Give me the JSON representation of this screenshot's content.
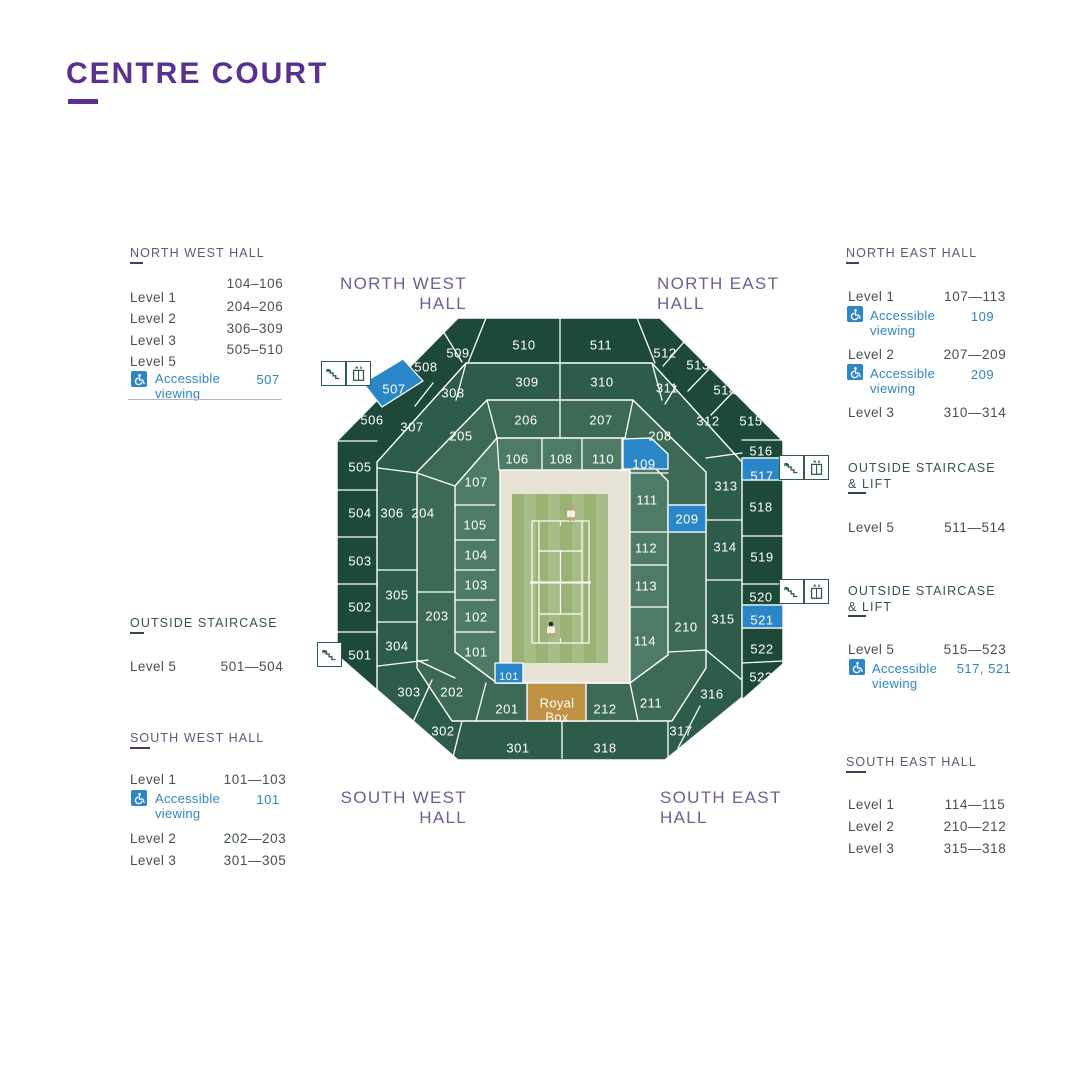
{
  "page": {
    "title": "CENTRE COURT"
  },
  "colors": {
    "accent_purple": "#5a3090",
    "hall_label_purple": "#6a5f96",
    "panel_heading_purple": "#5e5878",
    "staircase_heading_green": "#35544a",
    "body_text": "#44524d",
    "accessible_blue": "#2e86c3",
    "section_blue": "#2a86c7",
    "level5_green": "#1d4939",
    "level3_green": "#2e5c4a",
    "level2_green": "#3c6a56",
    "level1_green": "#4d7b65",
    "royal_box_gold": "#c09243",
    "surround_beige": "#e7e3d5",
    "grass_light": "#a7bd87",
    "grass_dark": "#9ab274",
    "icon_teal": "#2e5c4b"
  },
  "panels": {
    "nw": {
      "heading": "NORTH WEST HALL",
      "rows": [
        {
          "label": "Level 1",
          "value": "104–106"
        },
        {
          "label": "Level 2",
          "value": "204–206"
        },
        {
          "label": "Level 3",
          "value": "306–309"
        },
        {
          "label": "Level 5",
          "value": "505–510"
        }
      ],
      "acc": {
        "label": "Accessible viewing",
        "value": "507"
      }
    },
    "os_w": {
      "heading": "OUTSIDE STAIRCASE",
      "rows": [
        {
          "label": "Level 5",
          "value": "501—504"
        }
      ]
    },
    "sw": {
      "heading": "SOUTH WEST HALL",
      "rows": [
        {
          "label": "Level 1",
          "value": "101—103"
        },
        {
          "label": "Level 2",
          "value": "202—203"
        },
        {
          "label": "Level 3",
          "value": "301—305"
        }
      ],
      "acc": {
        "label": "Accessible viewing",
        "value": "101"
      }
    },
    "ne": {
      "heading": "NORTH EAST HALL",
      "rows": [
        {
          "label": "Level 1",
          "value": "107—113"
        },
        {
          "label": "Level 2",
          "value": "207—209"
        },
        {
          "label": "Level 3",
          "value": "310—314"
        }
      ],
      "acc1": {
        "label": "Accessible viewing",
        "value": "109"
      },
      "acc2": {
        "label": "Accessible viewing",
        "value": "209"
      }
    },
    "os_e1": {
      "heading": "OUTSIDE STAIRCASE & LIFT",
      "rows": [
        {
          "label": "Level 5",
          "value": "511—514"
        }
      ]
    },
    "os_e2": {
      "heading": "OUTSIDE STAIRCASE & LIFT",
      "rows": [
        {
          "label": "Level 5",
          "value": "515—523"
        }
      ],
      "acc": {
        "label": "Accessible viewing",
        "value": "517, 521"
      }
    },
    "se": {
      "heading": "SOUTH EAST HALL",
      "rows": [
        {
          "label": "Level 1",
          "value": "114—115"
        },
        {
          "label": "Level 2",
          "value": "210—212"
        },
        {
          "label": "Level 3",
          "value": "315—318"
        }
      ]
    }
  },
  "map": {
    "hall_labels": {
      "nw": {
        "line1": "NORTH WEST",
        "line2": "HALL"
      },
      "ne": {
        "line1": "NORTH EAST",
        "line2": "HALL"
      },
      "sw": {
        "line1": "SOUTH WEST",
        "line2": "HALL"
      },
      "se": {
        "line1": "SOUTH EAST",
        "line2": "HALL"
      }
    },
    "royal_box": {
      "line1": "Royal",
      "line2": "Box"
    },
    "icon_groups": [
      {
        "id": "nw-corner",
        "icons": [
          "stairs",
          "lift"
        ]
      },
      {
        "id": "west",
        "icons": [
          "stairs"
        ]
      },
      {
        "id": "east-upper",
        "icons": [
          "stairs",
          "lift"
        ]
      },
      {
        "id": "east-lower",
        "icons": [
          "stairs",
          "lift"
        ]
      }
    ],
    "sections": [
      {
        "n": "510",
        "x": 524,
        "y": 345
      },
      {
        "n": "511",
        "x": 601,
        "y": 345
      },
      {
        "n": "512",
        "x": 665,
        "y": 353
      },
      {
        "n": "513",
        "x": 698,
        "y": 365
      },
      {
        "n": "514",
        "x": 725,
        "y": 390
      },
      {
        "n": "515",
        "x": 751,
        "y": 421
      },
      {
        "n": "509",
        "x": 458,
        "y": 353
      },
      {
        "n": "508",
        "x": 426,
        "y": 367
      },
      {
        "n": "507",
        "x": 394,
        "y": 389,
        "b": true
      },
      {
        "n": "506",
        "x": 372,
        "y": 420
      },
      {
        "n": "307",
        "x": 412,
        "y": 427
      },
      {
        "n": "308",
        "x": 453,
        "y": 393
      },
      {
        "n": "309",
        "x": 527,
        "y": 382
      },
      {
        "n": "310",
        "x": 602,
        "y": 382
      },
      {
        "n": "311",
        "x": 667,
        "y": 388
      },
      {
        "n": "312",
        "x": 708,
        "y": 421
      },
      {
        "n": "205",
        "x": 461,
        "y": 436
      },
      {
        "n": "206",
        "x": 526,
        "y": 420
      },
      {
        "n": "207",
        "x": 601,
        "y": 420
      },
      {
        "n": "208",
        "x": 660,
        "y": 436
      },
      {
        "n": "106",
        "x": 517,
        "y": 459
      },
      {
        "n": "108",
        "x": 561,
        "y": 459
      },
      {
        "n": "110",
        "x": 603,
        "y": 459
      },
      {
        "n": "109",
        "x": 644,
        "y": 464,
        "b": true
      },
      {
        "n": "505",
        "x": 360,
        "y": 467
      },
      {
        "n": "504",
        "x": 360,
        "y": 513
      },
      {
        "n": "503",
        "x": 360,
        "y": 561
      },
      {
        "n": "502",
        "x": 360,
        "y": 607
      },
      {
        "n": "501",
        "x": 360,
        "y": 655
      },
      {
        "n": "306",
        "x": 392,
        "y": 513
      },
      {
        "n": "305",
        "x": 397,
        "y": 595
      },
      {
        "n": "304",
        "x": 397,
        "y": 646
      },
      {
        "n": "204",
        "x": 423,
        "y": 513
      },
      {
        "n": "203",
        "x": 437,
        "y": 616
      },
      {
        "n": "107",
        "x": 476,
        "y": 482
      },
      {
        "n": "105",
        "x": 475,
        "y": 525
      },
      {
        "n": "104",
        "x": 476,
        "y": 555
      },
      {
        "n": "103",
        "x": 476,
        "y": 585
      },
      {
        "n": "102",
        "x": 476,
        "y": 617
      },
      {
        "n": "101",
        "x": 476,
        "y": 652
      },
      {
        "n": "111",
        "x": 647,
        "y": 500
      },
      {
        "n": "112",
        "x": 646,
        "y": 548
      },
      {
        "n": "113",
        "x": 646,
        "y": 586
      },
      {
        "n": "114",
        "x": 645,
        "y": 641
      },
      {
        "n": "209",
        "x": 687,
        "y": 519,
        "b": true
      },
      {
        "n": "210",
        "x": 686,
        "y": 627
      },
      {
        "n": "313",
        "x": 726,
        "y": 486
      },
      {
        "n": "314",
        "x": 725,
        "y": 547
      },
      {
        "n": "315",
        "x": 723,
        "y": 619
      },
      {
        "n": "516",
        "x": 761,
        "y": 451
      },
      {
        "n": "517",
        "x": 762,
        "y": 476,
        "b": true
      },
      {
        "n": "518",
        "x": 761,
        "y": 507
      },
      {
        "n": "519",
        "x": 762,
        "y": 557
      },
      {
        "n": "520",
        "x": 761,
        "y": 597
      },
      {
        "n": "521",
        "x": 762,
        "y": 620,
        "b": true
      },
      {
        "n": "522",
        "x": 762,
        "y": 649
      },
      {
        "n": "523",
        "x": 761,
        "y": 677
      },
      {
        "n": "303",
        "x": 409,
        "y": 692
      },
      {
        "n": "202",
        "x": 452,
        "y": 692
      },
      {
        "n": "201",
        "x": 507,
        "y": 709
      },
      {
        "n": "212",
        "x": 605,
        "y": 709
      },
      {
        "n": "211",
        "x": 651,
        "y": 703
      },
      {
        "n": "316",
        "x": 712,
        "y": 694
      },
      {
        "n": "317",
        "x": 681,
        "y": 731
      },
      {
        "n": "302",
        "x": 443,
        "y": 731
      },
      {
        "n": "301",
        "x": 518,
        "y": 748
      },
      {
        "n": "318",
        "x": 605,
        "y": 748
      },
      {
        "n": "101",
        "x": 509,
        "y": 677,
        "b": true,
        "s": true
      }
    ]
  }
}
